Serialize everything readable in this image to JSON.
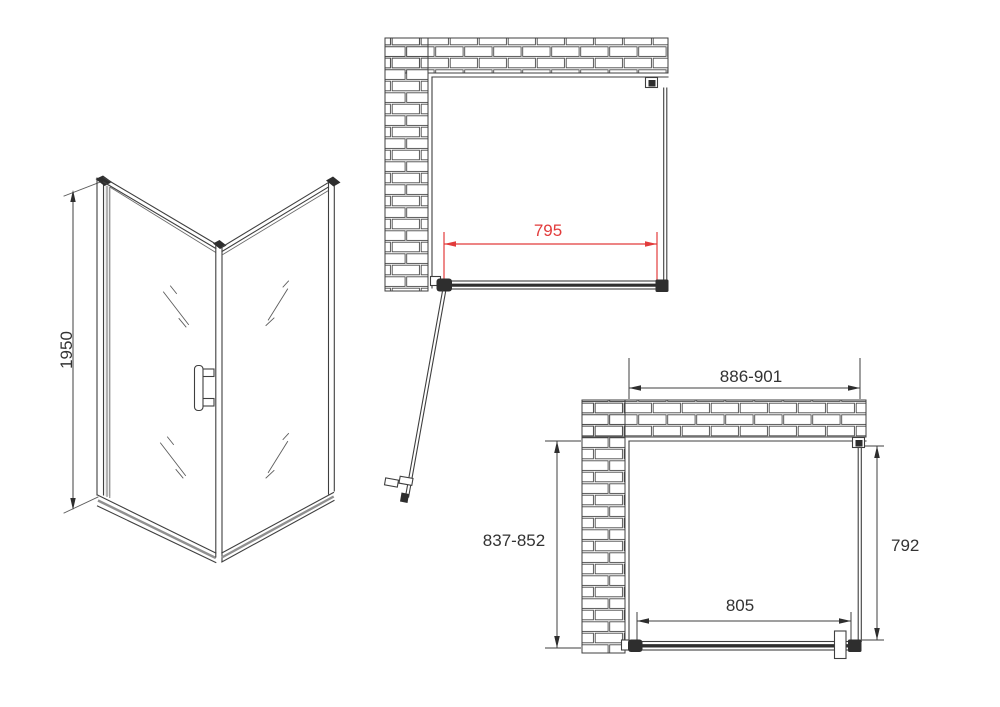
{
  "drawing": {
    "views": {
      "isometric": {
        "height_label": "1950"
      },
      "top_plan": {
        "door_width_label": "795"
      },
      "bottom_plan": {
        "overall_width_label": "886-901",
        "overall_depth_label": "837-852",
        "side_panel_label": "792",
        "door_opening_label": "805"
      }
    },
    "colors": {
      "line": "#3f3f3f",
      "accent_red": "#e23b3b",
      "text": "#333333"
    }
  }
}
